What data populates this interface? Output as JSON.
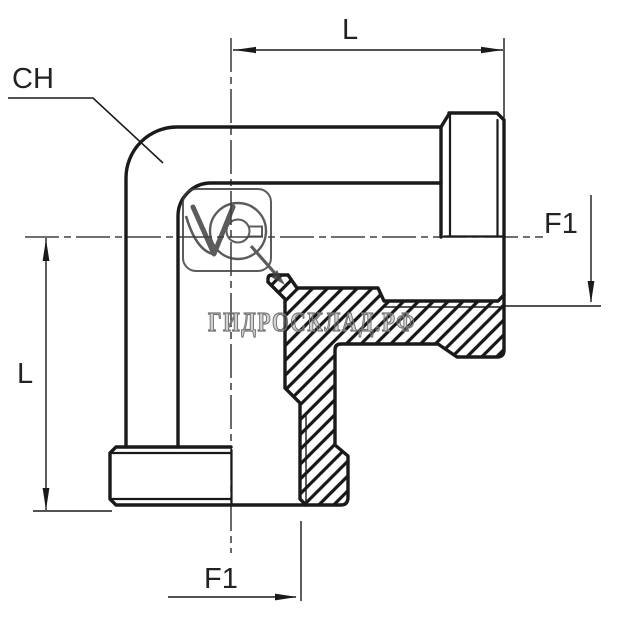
{
  "drawing": {
    "title": "90-degree elbow fitting technical drawing",
    "labels": {
      "hex_size": "CH",
      "length_top": "L",
      "length_left": "L",
      "thread_right": "F1",
      "thread_bottom": "F1"
    },
    "watermark": {
      "text": "ГИДРОСКЛАД.РФ"
    },
    "colors": {
      "background": "#ffffff",
      "line": "#1a1a1a",
      "label": "#222222",
      "watermark": "#757575",
      "logo": "#404040"
    }
  }
}
